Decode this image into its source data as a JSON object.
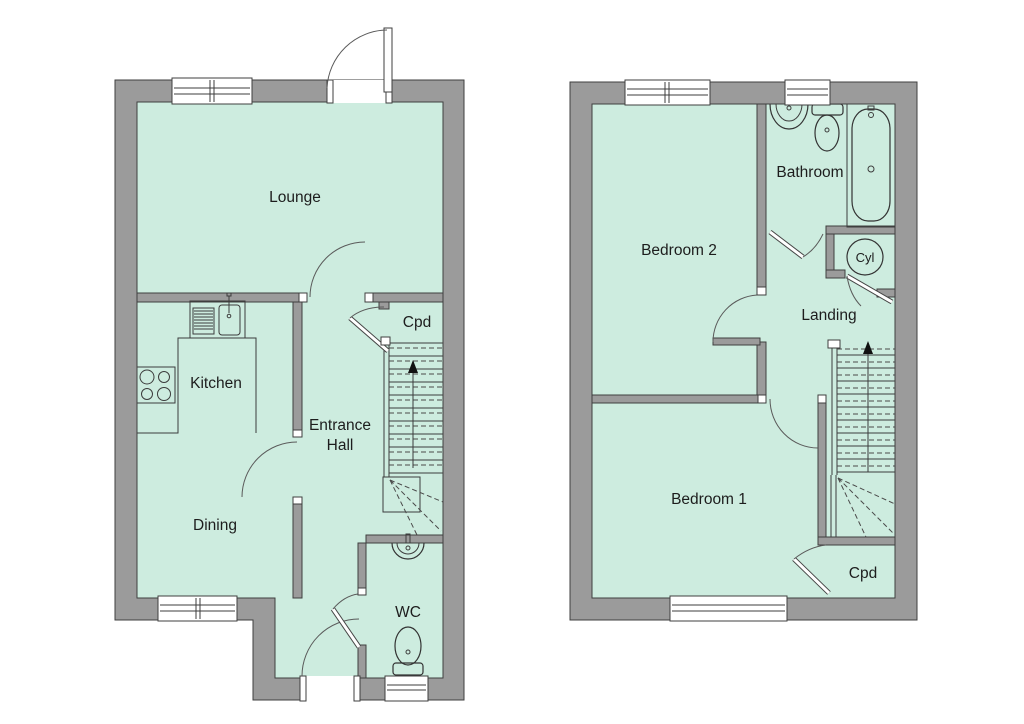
{
  "colors": {
    "wall": "#9b9b9b",
    "room": "#cdecdf",
    "line": "#3f3f3f",
    "background": "#ffffff"
  },
  "ground_floor": {
    "rooms": {
      "lounge": "Lounge",
      "kitchen": "Kitchen",
      "dining": "Dining",
      "entrance_hall_line1": "Entrance",
      "entrance_hall_line2": "Hall",
      "cupboard": "Cpd",
      "wc": "WC"
    }
  },
  "first_floor": {
    "rooms": {
      "bedroom2": "Bedroom 2",
      "bathroom": "Bathroom",
      "landing": "Landing",
      "bedroom1": "Bedroom 1",
      "cupboard": "Cpd",
      "cylinder": "Cyl"
    }
  }
}
